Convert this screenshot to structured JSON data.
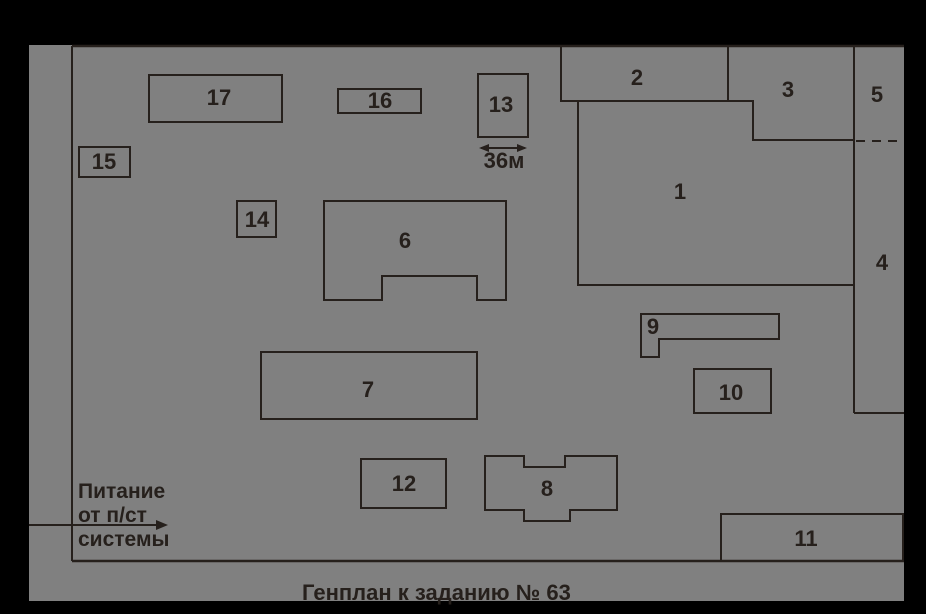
{
  "title": "Генплан к заданию № 63",
  "colors": {
    "background": "#000000",
    "site_fill": "#808080",
    "line": "#26201c",
    "text": "#26201c"
  },
  "feed": {
    "line1": "Питание",
    "line2": "от п/ст",
    "line3": "системы"
  },
  "dimension": {
    "label": "36м"
  },
  "buildings": [
    {
      "label": "1"
    },
    {
      "label": "2"
    },
    {
      "label": "3"
    },
    {
      "label": "4"
    },
    {
      "label": "5"
    },
    {
      "label": "6"
    },
    {
      "label": "7"
    },
    {
      "label": "8"
    },
    {
      "label": "9"
    },
    {
      "label": "10"
    },
    {
      "label": "11"
    },
    {
      "label": "12"
    },
    {
      "label": "13"
    },
    {
      "label": "14"
    },
    {
      "label": "15"
    },
    {
      "label": "16"
    },
    {
      "label": "17"
    }
  ]
}
